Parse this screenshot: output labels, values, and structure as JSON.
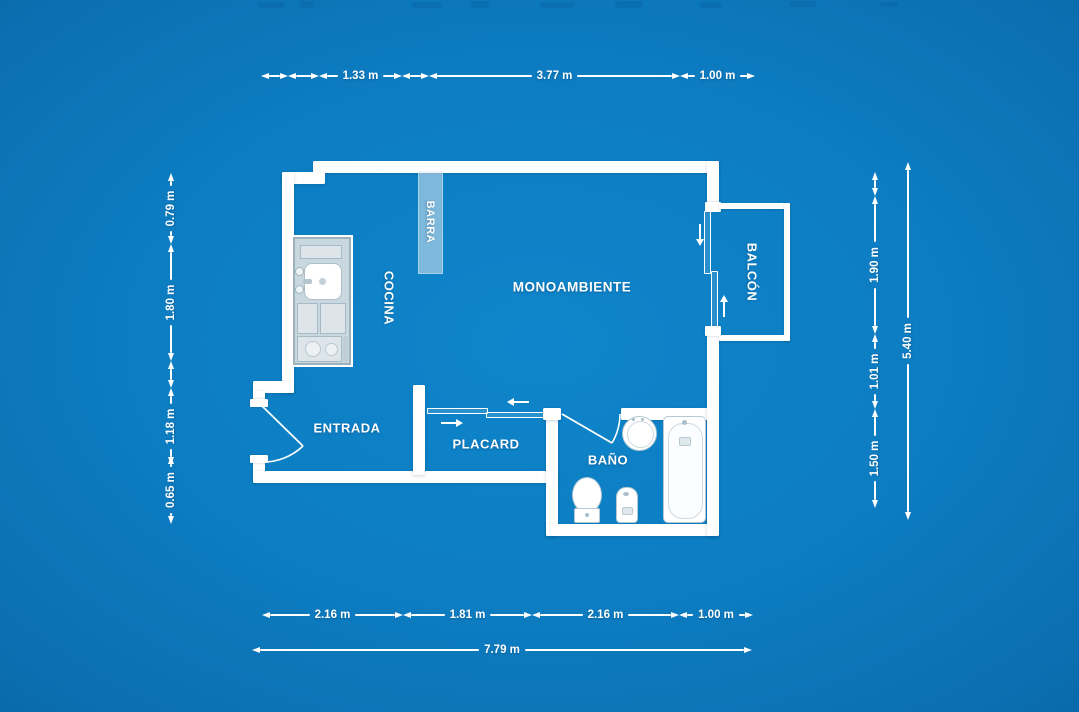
{
  "plan_title": "studio apartment floor plan",
  "rooms": {
    "monoambiente": "MONOAMBIENTE",
    "cocina": "COCINA",
    "barra": "BARRA",
    "entrada": "ENTRADA",
    "placard": "PLACARD",
    "bano": "BAÑO",
    "balcon": "BALCÓN"
  },
  "dims": {
    "top_1_33": "1.33 m",
    "top_3_77": "3.77 m",
    "top_1_00": "1.00 m",
    "left_0_79": "0.79 m",
    "left_1_80": "1.80 m",
    "left_1_18": "1.18 m",
    "left_0_65": "0.65 m",
    "right_1_90": "1.90 m",
    "right_1_01": "1.01 m",
    "right_1_50": "1.50 m",
    "right_total_5_40": "5.40 m",
    "bottom_2_16_a": "2.16 m",
    "bottom_1_81": "1.81 m",
    "bottom_2_16_b": "2.16 m",
    "bottom_1_00": "1.00 m",
    "bottom_total_7_79": "7.79 m"
  },
  "colors": {
    "background": "#0d7ec3",
    "wall": "#ffffff",
    "label_text": "#ffffff",
    "fixture_outline": "#b6c8d1",
    "counter_fill": "#c9d7de",
    "barra_fill": "rgba(221,232,238,0.55)"
  }
}
